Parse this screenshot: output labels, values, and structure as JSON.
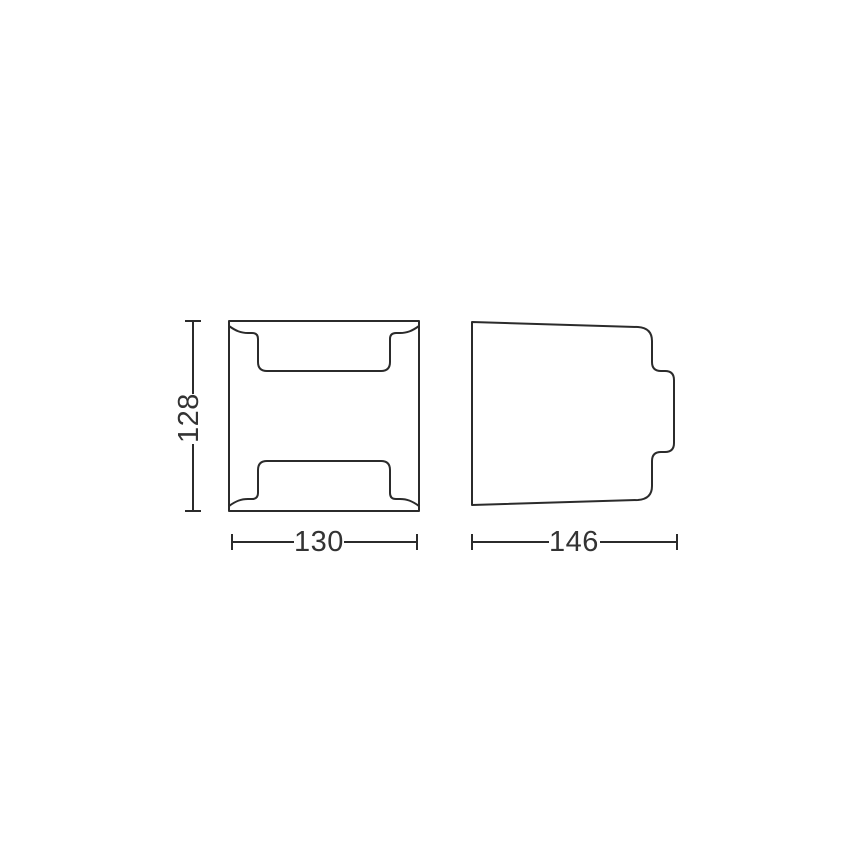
{
  "colors": {
    "line": "#2b2b2b",
    "text": "#333333",
    "background": "#ffffff"
  },
  "drawing": {
    "type": "technical-dimension-drawing",
    "views": [
      {
        "id": "front-view",
        "description": "front elevation of luminaire"
      },
      {
        "id": "side-view",
        "description": "side profile of luminaire with wall-mount nub"
      }
    ],
    "dimensions": {
      "height_label": "128",
      "width_label": "130",
      "depth_label": "146"
    }
  }
}
